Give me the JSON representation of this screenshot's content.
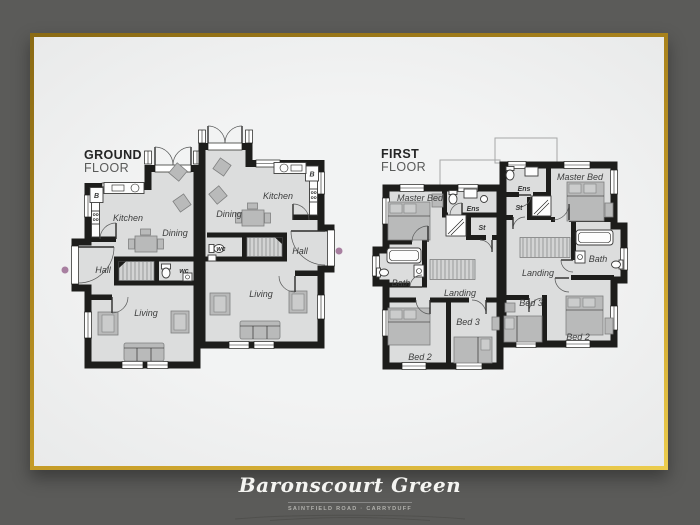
{
  "palette": {
    "background": "#5b5b59",
    "mat": "#e9eaea",
    "wall": "#1d1d1b",
    "room_fill": "#dcdddd",
    "furniture_fill": "#b9baba",
    "label_color": "#3c3d3d",
    "accent_dot": "#a87fa0",
    "gold_light": "#eccd4e",
    "gold_dark": "#8a6a14",
    "title_color": "#f4f4f1",
    "subtitle_color": "#b2b2ae"
  },
  "ground_floor": {
    "label_line1": "GROUND",
    "label_line2": "FLOOR",
    "left_house": {
      "kitchen": "Kitchen",
      "dining": "Dining",
      "hall": "Hall",
      "living": "Living",
      "wc": "wc",
      "boiler": "B"
    },
    "right_house": {
      "kitchen": "Kitchen",
      "dining": "Dining",
      "hall": "Hall",
      "living": "Living",
      "wc": "wc",
      "boiler": "B"
    }
  },
  "first_floor": {
    "label_line1": "FIRST",
    "label_line2": "FLOOR",
    "left_house": {
      "master_bed": "Master Bed",
      "ens": "Ens",
      "st": "St",
      "bath": "Bath",
      "landing": "Landing",
      "bed3": "Bed 3",
      "bed2": "Bed 2"
    },
    "right_house": {
      "master_bed": "Master Bed",
      "ens": "Ens",
      "st": "St",
      "bath": "Bath",
      "landing": "Landing",
      "bed3": "Bed 3",
      "bed2": "Bed 2"
    }
  },
  "footer": {
    "title": "Baronscourt Green",
    "subtitle": "SAINTFIELD ROAD · CARRYDUFF"
  }
}
